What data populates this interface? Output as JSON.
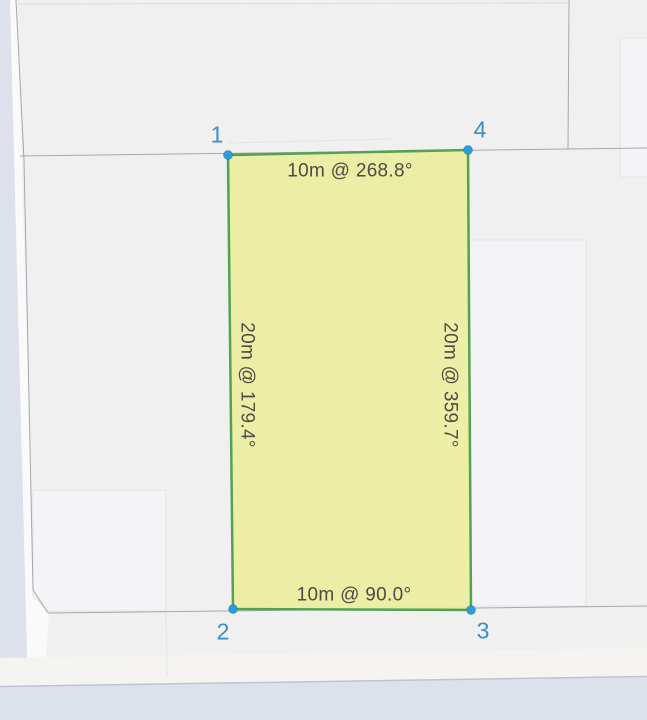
{
  "theme": {
    "map-bg": "#f0f0f1",
    "road-fill": "#dce1ec",
    "road-edge": "#bdc3d0",
    "parcel-line": "#a6a8ad",
    "building-fill": "#f4f4f6",
    "building-edge": "#e4e4e8",
    "plot-fill": "rgba(234,236,140,0.76)",
    "plot-stroke": "#52a254",
    "vertex-fill": "#2b9cd8",
    "vertex-label-color": "#3d8ecd",
    "edge-label-color": "#4c4c44"
  },
  "parcel": {
    "vertices": [
      {
        "id": "1",
        "label": "1"
      },
      {
        "id": "2",
        "label": "2"
      },
      {
        "id": "3",
        "label": "3"
      },
      {
        "id": "4",
        "label": "4"
      }
    ],
    "edges": [
      {
        "side": "top",
        "label": "10m @ 268.8°"
      },
      {
        "side": "right",
        "label": "20m @ 359.7°"
      },
      {
        "side": "bottom",
        "label": "10m @ 90.0°"
      },
      {
        "side": "left",
        "label": "20m @ 179.4°"
      }
    ]
  }
}
